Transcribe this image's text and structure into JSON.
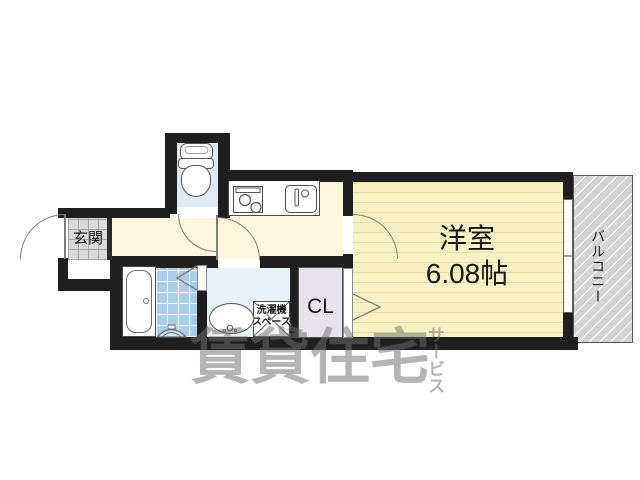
{
  "rooms": {
    "entrance_label": "玄関",
    "western_room_label": "洋室",
    "western_room_size": "6.08帖",
    "closet_label": "CL",
    "balcony_label": "バルコニー",
    "washer_space_line1": "洗濯機",
    "washer_space_line2": "スペース"
  },
  "watermark": {
    "main": "賃貸住宅",
    "vertical": "サービス"
  },
  "colors": {
    "wall": "#1f1f1f",
    "hall_floor": "#fbf6dc",
    "room_floor": "#f8f1c3",
    "toilet_floor": "#dfeaf7",
    "washroom_floor": "#e7f2fb",
    "bath_tile": "#a9cdec",
    "genkan_tile": "#d9d9d9",
    "closet_floor": "#e6e3ec",
    "balcony_fill": "#d3d3d3",
    "watermark_gray": "#707070"
  }
}
